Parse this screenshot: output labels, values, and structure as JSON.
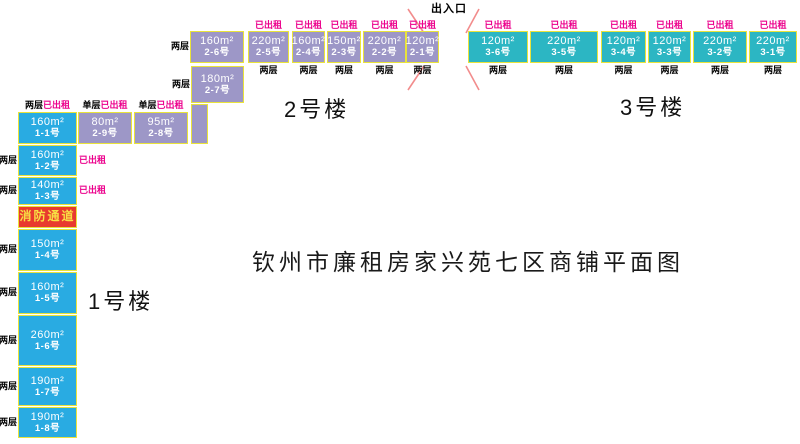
{
  "title": "钦州市廉租房家兴苑七区商铺平面图",
  "entrance": {
    "label": "出入口"
  },
  "labels": {
    "rented": "已出租",
    "two_floors": "两层",
    "single_floor": "单层"
  },
  "fire_passage": {
    "label": "消防通道"
  },
  "buildings": [
    {
      "name": "1号楼",
      "units": [
        {
          "area": "160m²",
          "unit": "1-1号",
          "color": "blue",
          "x": 18,
          "y": 112,
          "w": 59,
          "h": 32,
          "floors": "两层",
          "floors_pos": "header",
          "rented": true,
          "rented_pos": "header"
        },
        {
          "area": "160m²",
          "unit": "1-2号",
          "color": "blue",
          "x": 18,
          "y": 145,
          "w": 59,
          "h": 31,
          "floors": "两层",
          "floors_pos": "left",
          "rented": true,
          "rented_pos": "right"
        },
        {
          "area": "140m²",
          "unit": "1-3号",
          "color": "blue",
          "x": 18,
          "y": 177,
          "w": 59,
          "h": 28,
          "floors": "两层",
          "floors_pos": "left",
          "rented": true,
          "rented_pos": "right"
        },
        {
          "label": "消防通道",
          "color": "red",
          "x": 18,
          "y": 206,
          "w": 59,
          "h": 22
        },
        {
          "area": "150m²",
          "unit": "1-4号",
          "color": "blue",
          "x": 18,
          "y": 229,
          "w": 59,
          "h": 42,
          "floors": "两层",
          "floors_pos": "left",
          "rented": false
        },
        {
          "area": "160m²",
          "unit": "1-5号",
          "color": "blue",
          "x": 18,
          "y": 272,
          "w": 59,
          "h": 42,
          "floors": "两层",
          "floors_pos": "left",
          "rented": false
        },
        {
          "area": "260m²",
          "unit": "1-6号",
          "color": "blue",
          "x": 18,
          "y": 315,
          "w": 59,
          "h": 51,
          "floors": "两层",
          "floors_pos": "left",
          "rented": false
        },
        {
          "area": "190m²",
          "unit": "1-7号",
          "color": "blue",
          "x": 18,
          "y": 367,
          "w": 59,
          "h": 39,
          "floors": "两层",
          "floors_pos": "left",
          "rented": false
        },
        {
          "area": "190m²",
          "unit": "1-8号",
          "color": "blue",
          "x": 18,
          "y": 407,
          "w": 59,
          "h": 31,
          "floors": "两层",
          "floors_pos": "left",
          "rented": false
        }
      ]
    },
    {
      "name": "2号楼",
      "units": [
        {
          "area": "160m²",
          "unit": "2-6号",
          "color": "purple",
          "x": 190,
          "y": 31,
          "w": 54,
          "h": 32,
          "floors": "两层",
          "floors_pos": "left",
          "rented": false
        },
        {
          "area": "180m²",
          "unit": "2-7号",
          "color": "purple",
          "x": 191,
          "y": 66,
          "w": 53,
          "h": 37,
          "floors": "两层",
          "floors_pos": "left",
          "rented": false
        },
        {
          "color": "purple",
          "x": 191,
          "y": 104,
          "w": 17,
          "h": 40
        },
        {
          "area": "80m²",
          "unit": "2-9号",
          "color": "purple",
          "x": 78,
          "y": 112,
          "w": 54,
          "h": 32,
          "floors": "单层",
          "floors_pos": "header",
          "rented": true,
          "rented_pos": "header"
        },
        {
          "area": "95m²",
          "unit": "2-8号",
          "color": "purple",
          "x": 134,
          "y": 112,
          "w": 54,
          "h": 32,
          "floors": "单层",
          "floors_pos": "header",
          "rented": true,
          "rented_pos": "header"
        },
        {
          "area": "220m²",
          "unit": "2-5号",
          "color": "purple",
          "x": 248,
          "y": 31,
          "w": 41,
          "h": 32,
          "floors": "两层",
          "floors_pos": "below",
          "rented": true,
          "rented_pos": "above"
        },
        {
          "area": "160m²",
          "unit": "2-4号",
          "color": "purple",
          "x": 292,
          "y": 31,
          "w": 33,
          "h": 32,
          "floors": "两层",
          "floors_pos": "below",
          "rented": true,
          "rented_pos": "above"
        },
        {
          "area": "150m²",
          "unit": "2-3号",
          "color": "purple",
          "x": 327,
          "y": 31,
          "w": 34,
          "h": 32,
          "floors": "两层",
          "floors_pos": "below",
          "rented": true,
          "rented_pos": "above"
        },
        {
          "area": "220m²",
          "unit": "2-2号",
          "color": "purple",
          "x": 363,
          "y": 31,
          "w": 43,
          "h": 32,
          "floors": "两层",
          "floors_pos": "below",
          "rented": true,
          "rented_pos": "above"
        },
        {
          "area": "120m²",
          "unit": "2-1号",
          "color": "purple",
          "x": 406,
          "y": 31,
          "w": 33,
          "h": 32,
          "floors": "两层",
          "floors_pos": "below",
          "rented": true,
          "rented_pos": "above"
        }
      ]
    },
    {
      "name": "3号楼",
      "units": [
        {
          "area": "120m²",
          "unit": "3-6号",
          "color": "teal",
          "x": 468,
          "y": 31,
          "w": 60,
          "h": 32,
          "floors": "两层",
          "floors_pos": "below",
          "rented": true,
          "rented_pos": "above"
        },
        {
          "area": "220m²",
          "unit": "3-5号",
          "color": "teal",
          "x": 530,
          "y": 31,
          "w": 68,
          "h": 32,
          "floors": "两层",
          "floors_pos": "below",
          "rented": true,
          "rented_pos": "above"
        },
        {
          "area": "120m²",
          "unit": "3-4号",
          "color": "teal",
          "x": 601,
          "y": 31,
          "w": 45,
          "h": 32,
          "floors": "两层",
          "floors_pos": "below",
          "rented": true,
          "rented_pos": "above"
        },
        {
          "area": "120m²",
          "unit": "3-3号",
          "color": "teal",
          "x": 648,
          "y": 31,
          "w": 43,
          "h": 32,
          "floors": "两层",
          "floors_pos": "below",
          "rented": true,
          "rented_pos": "above"
        },
        {
          "area": "220m²",
          "unit": "3-2号",
          "color": "teal",
          "x": 693,
          "y": 31,
          "w": 54,
          "h": 32,
          "floors": "两层",
          "floors_pos": "below",
          "rented": true,
          "rented_pos": "above"
        },
        {
          "area": "220m²",
          "unit": "3-1号",
          "color": "teal",
          "x": 749,
          "y": 31,
          "w": 48,
          "h": 32,
          "floors": "两层",
          "floors_pos": "below",
          "rented": true,
          "rented_pos": "above"
        }
      ]
    }
  ],
  "colors": {
    "blue": "#29ABE2",
    "purple": "#9D97C7",
    "teal": "#2CB6C3",
    "fire_red": "#E83A2E",
    "rented_magenta": "#EC008C",
    "border_yellow": "#E9E33B",
    "entrance_line_pink": "#F28C8C"
  }
}
